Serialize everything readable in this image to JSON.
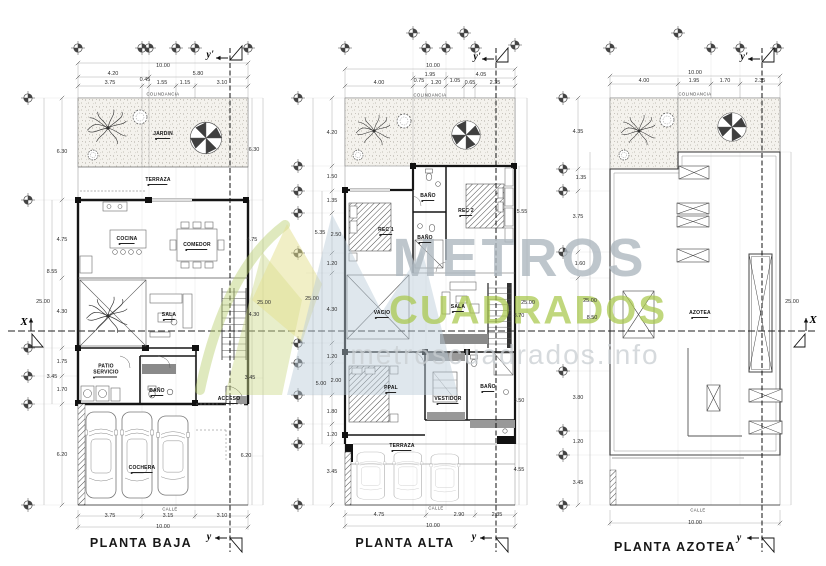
{
  "watermark": {
    "brand_top": "METROS",
    "brand_bottom": "CUADRADOS",
    "site": "metroscuadrados.info"
  },
  "axes": {
    "x": "X",
    "y_top": "y'",
    "y_bottom": "y"
  },
  "plans": [
    {
      "title": "PLANTA BAJA",
      "colindancia": "COLINDANCIA",
      "calle": "CALLE",
      "rooms": [
        "JARDIN",
        "TERRAZA",
        "COCINA",
        "COMEDOR",
        "SALA",
        "PATIO SERVICIO",
        "BAÑO",
        "ACCESO",
        "COCHERA"
      ],
      "dims": {
        "top": [
          "10.00",
          "4.20",
          "5.80",
          "3.75",
          "0.45",
          "1.55",
          "1.15",
          "3.10"
        ],
        "left": [
          "6.30",
          "4.75",
          "8.55",
          "25.00",
          "4.30",
          "1.75",
          "3.45",
          "1.70",
          "6.20"
        ],
        "right": [
          "6.30",
          "4.75",
          "25.00",
          "4.30",
          "3.45",
          "6.20"
        ],
        "bottom": [
          "3.75",
          "3.15",
          "3.10",
          "10.00"
        ]
      }
    },
    {
      "title": "PLANTA ALTA",
      "colindancia": "COLINDANCIA",
      "calle": "CALLE",
      "rooms": [
        "REC 1",
        "BAÑO",
        "BAÑO",
        "REC 2",
        "VACIO",
        "SALA",
        "PPAL",
        "VESTIDOR",
        "BAÑO",
        "TERRAZA"
      ],
      "dims": {
        "top": [
          "10.00",
          "1.95",
          "4.05",
          "4.00",
          "0.75",
          "1.20",
          "1.05",
          "0.65",
          "2.35"
        ],
        "left": [
          "4.20",
          "1.50",
          "1.35",
          "5.35",
          "2.50",
          "1.20",
          "25.00",
          "4.30",
          "1.20",
          "5.00",
          "2.00",
          "1.80",
          "1.20",
          "3.45"
        ],
        "right": [
          "5.55",
          "25.00",
          "8.70",
          "3.50",
          "4.55"
        ],
        "bottom": [
          "4.75",
          "2.90",
          "2.35",
          "10.00"
        ]
      }
    },
    {
      "title": "PLANTA AZOTEA",
      "colindancia": "COLINDANCIA",
      "calle": "CALLE",
      "rooms": [
        "AZOTEA"
      ],
      "dims": {
        "top": [
          "10.00",
          "4.00",
          "1.95",
          "1.70",
          "2.35"
        ],
        "left": [
          "4.35",
          "1.35",
          "3.75",
          "1.60",
          "25.00",
          "8.50",
          "3.80",
          "1.20",
          "3.45"
        ],
        "right": [
          "25.00"
        ],
        "bottom": [
          "10.00"
        ]
      }
    }
  ]
}
